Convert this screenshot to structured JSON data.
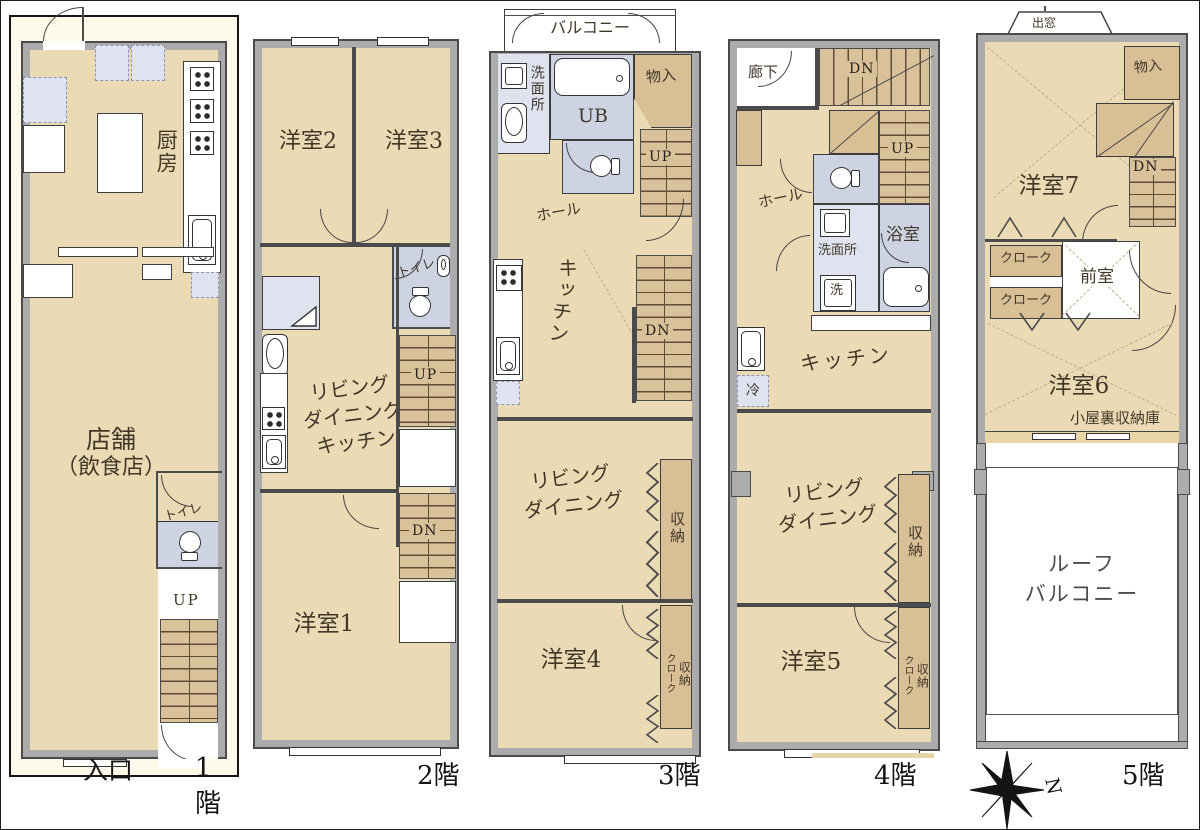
{
  "colors": {
    "room_beige": "#ebdbb4",
    "wall_gray": "#acacac",
    "wall_line": "#4b4b4b",
    "stair_tan": "#d9c29a",
    "closet_tan": "#d8bf95",
    "bath_blue": "#cdd3e3",
    "fixture_blue": "#dfe3f0",
    "highlight_cream": "#fdfae9",
    "label_brown": "#42382a"
  },
  "floors": [
    {
      "floor_label": "1階",
      "labels": {
        "kitchen": "厨房",
        "shop_line1": "店舗",
        "shop_line2": "（飲食店）",
        "toilet": "トイレ",
        "up": "UP",
        "entrance": "入口"
      }
    },
    {
      "floor_label": "2階",
      "labels": {
        "room2": "洋室2",
        "room3": "洋室3",
        "toilet": "トイレ",
        "ldk_line1": "リビング",
        "ldk_line2": "ダイニング",
        "ldk_line3": "キッチン",
        "up": "UP",
        "dn": "DN",
        "room1": "洋室1"
      }
    },
    {
      "floor_label": "3階",
      "labels": {
        "balcony": "バルコニー",
        "washroom": "洗面所",
        "unit_bath": "UB",
        "storage": "物入",
        "up": "UP",
        "hall": "ホール",
        "kitchen": "キッチン",
        "dn": "DN",
        "ld_line1": "リビング",
        "ld_line2": "ダイニング",
        "closet": "収納",
        "room4": "洋室4",
        "cloak": "クローク",
        "closet2": "収納"
      }
    },
    {
      "floor_label": "4階",
      "labels": {
        "corridor": "廊下",
        "dn": "DN",
        "up": "UP",
        "hall": "ホール",
        "washroom": "洗面所",
        "washer": "洗",
        "bathroom": "浴室",
        "kitchen": "キッチン",
        "fridge": "冷",
        "ld_line1": "リビング",
        "ld_line2": "ダイニング",
        "closet": "収納",
        "room5": "洋室5",
        "cloak": "クローク",
        "closet2": "収納"
      }
    },
    {
      "floor_label": "5階",
      "labels": {
        "bay_window": "出窓",
        "room7": "洋室7",
        "storage": "物入",
        "dn": "DN",
        "cloak1": "クローク",
        "cloak2": "クローク",
        "anteroom": "前室",
        "room6": "洋室6",
        "attic_storage": "小屋裏収納庫",
        "roof_line1": "ルーフ",
        "roof_line2": "バルコニー"
      }
    }
  ],
  "compass": {
    "north": "N"
  }
}
